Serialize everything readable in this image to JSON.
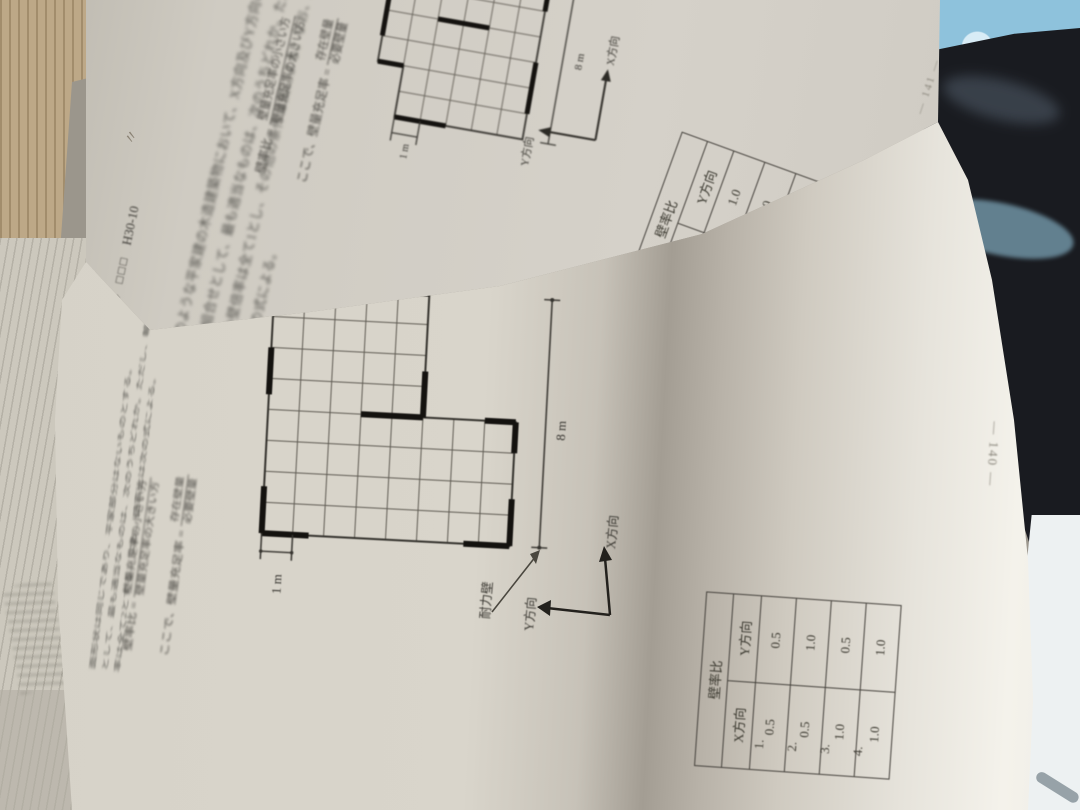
{
  "scene": {
    "description": "Photo of an open Japanese architecture exam textbook, pages rotated 90 degrees, page 140 curling up, page 141 behind",
    "colors": {
      "paper": "#d6d2c8",
      "paper_shadow": "#a39d93",
      "paper_highlight": "#f4f2eb",
      "ink": "#3f3d38",
      "blanket_blue": "#8ec2dc",
      "black_object": "#191b20",
      "tan_floor": "#bda887",
      "brown_floor": "#8b7158",
      "sunlit_floor": "#edf1f2"
    }
  },
  "page140": {
    "intro_lines": [
      "面形状は同じであり、平家部分はないものとする。",
      "として、最も適当なものは、次のうちどれか。ただし、軸組の倍",
      "率は全て2とする。なお、壁率比は次の式による。"
    ],
    "formula_ratio": {
      "lhs": "壁率比 =",
      "numerator": "壁量充足率の小さい方",
      "denominator": "壁量充足率の大きい方"
    },
    "formula_fullness": {
      "prefix": "ここで、",
      "lhs": "壁量充足率 =",
      "numerator": "存在壁量",
      "denominator": "必要壁量"
    },
    "figure": {
      "cell_dim": "1 m",
      "width_dim": "8 m",
      "wall_label": "耐力壁",
      "x_axis": "X方向",
      "y_axis": "Y方向"
    },
    "table": {
      "title": "壁率比",
      "col_x": "X方向",
      "col_y": "Y方向",
      "rows": [
        {
          "no": "1.",
          "x": "0.5",
          "y": "0.5"
        },
        {
          "no": "2.",
          "x": "0.5",
          "y": "1.0"
        },
        {
          "no": "3.",
          "x": "1.0",
          "y": "0.5"
        },
        {
          "no": "4.",
          "x": "1.0",
          "y": "1.0"
        }
      ]
    },
    "page_number": "— 140 —"
  },
  "page141": {
    "header": {
      "problem_no": "44",
      "checkboxes": "□□□",
      "exam_code": "H30-10",
      "pencil_marks": "〃"
    },
    "lines": [
      "のような平家建の木造建築物において、X方向及びY方向の壁率比",
      "の組合せとして、最も適当なものは、次のうちどれか。ただし、軸",
      "組の壁倍率は全て1とし、その他の条件は図による。なお、壁率比",
      "は次の式による。"
    ],
    "formula_ratio": {
      "lhs": "壁率比 =",
      "numerator": "壁量充足率の小さい方",
      "denominator": "壁量充足率の大きい方"
    },
    "formula_fullness": {
      "prefix": "ここで、",
      "lhs": "壁量充足率 =",
      "numerator": "存在壁量",
      "denominator": "必要壁量"
    },
    "figure": {
      "cell_dim": "1 m",
      "width_dim": "8 m",
      "x_axis": "X方向",
      "y_axis": "Y方向"
    },
    "table": {
      "title": "壁率比",
      "col_x": "X方向",
      "col_y": "Y方向",
      "rows": [
        {
          "no": "1.",
          "x": "0.5",
          "y": "1.0"
        },
        {
          "no": "2.",
          "x": "0.8",
          "y": "1.0"
        },
        {
          "no": "3.",
          "x": "1.0",
          "y": "0.5"
        },
        {
          "no": "4.",
          "x": "1.0",
          "y": "0.8"
        }
      ]
    },
    "page_number": "— 141 —"
  }
}
